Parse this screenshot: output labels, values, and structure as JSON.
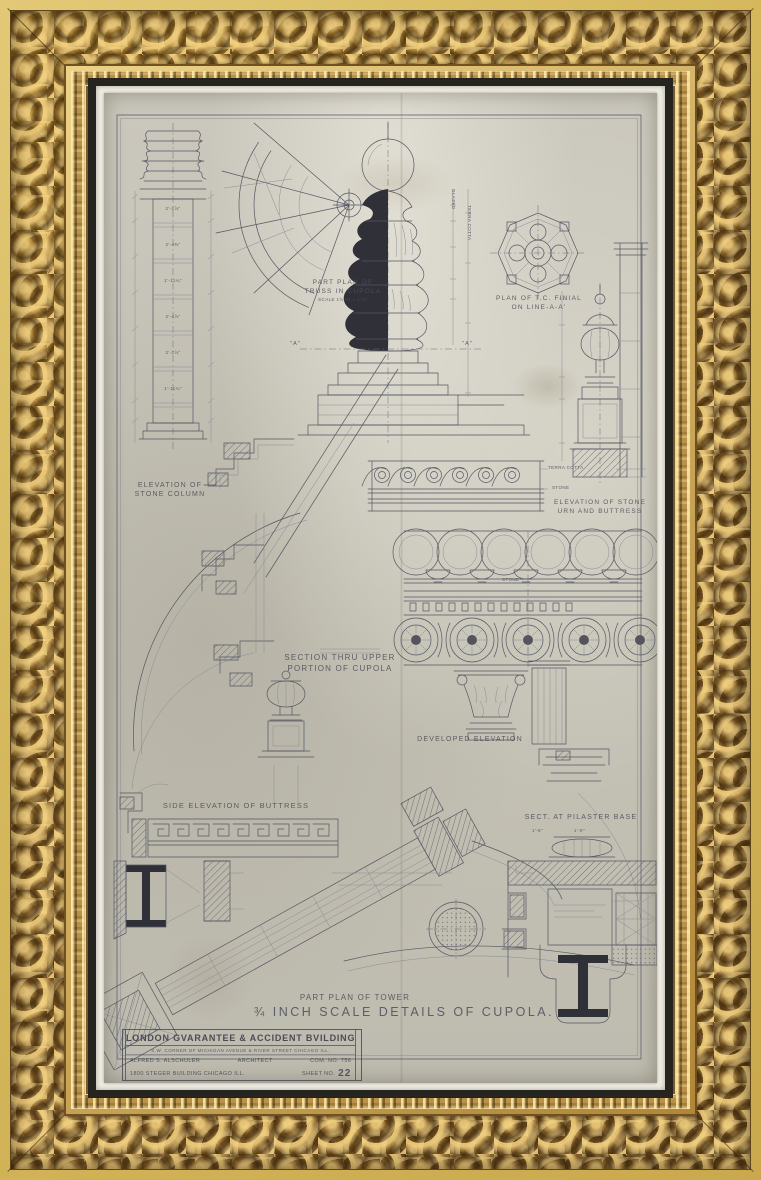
{
  "artwork": {
    "title": "¾ INCH SCALE DETAILS OF CUPOLA.",
    "labels": {
      "column": [
        "ELEVATION OF",
        "STONE COLUMN"
      ],
      "truss_plan": [
        "PART PLAN OF",
        "TRUSS IN CUPOLA"
      ],
      "truss_scale": "SCALE 1½ IN = 1'-0\"",
      "finial_plan": [
        "PLAN OF T.C. FINIAL",
        "ON LINE-A-A'"
      ],
      "urn": [
        "ELEVATION OF STONE",
        "URN AND BUTTRESS"
      ],
      "section": [
        "SECTION THRU UPPER",
        "PORTION OF CUPOLA"
      ],
      "developed": "DEVELOPED ELEVATION",
      "buttress": "SIDE ELEVATION OF BUTTRESS",
      "pilaster": "SECT. AT PILASTER BASE",
      "tower": "PART PLAN OF TOWER",
      "terra_cotta": "TERRA COTTA",
      "stone": "STONE",
      "stone2": "STONE",
      "glazed": "GLAZED",
      "terra_cotta_v": "TERRA COTTA",
      "mark_a_left": "\"A\"",
      "mark_a_right": "\"A\""
    },
    "dims": {
      "column": [
        "2'-2⅞\"",
        "2'-4⅜\"",
        "1'-11¼\"",
        "2'-4⅞\"",
        "2'-2⅞\"",
        "1'-11¼\""
      ],
      "pilaster_base": [
        "1'-8\"",
        "1'-8\""
      ]
    },
    "title_block": {
      "name": "LONDON GVARANTEE & ACCIDENT BVILDING",
      "address_line": "S.W. CORNER OF MICHIGAN AVENUE & RIVER STREET CHICAGO ILL.",
      "architect": "ALFRED S. ALSCHULER",
      "architect_title": "ARCHITECT",
      "com_no": "COM. NO. 756",
      "office": "1800 STEGER BUILDING  CHICAGO ILL.",
      "sheet_label": "SHEET NO.",
      "sheet_no": "22"
    },
    "colors": {
      "frame_gold": "#9a7434",
      "mat": "#f1efe6",
      "paper": "#c9c6bb",
      "ink": "#53545e"
    }
  }
}
